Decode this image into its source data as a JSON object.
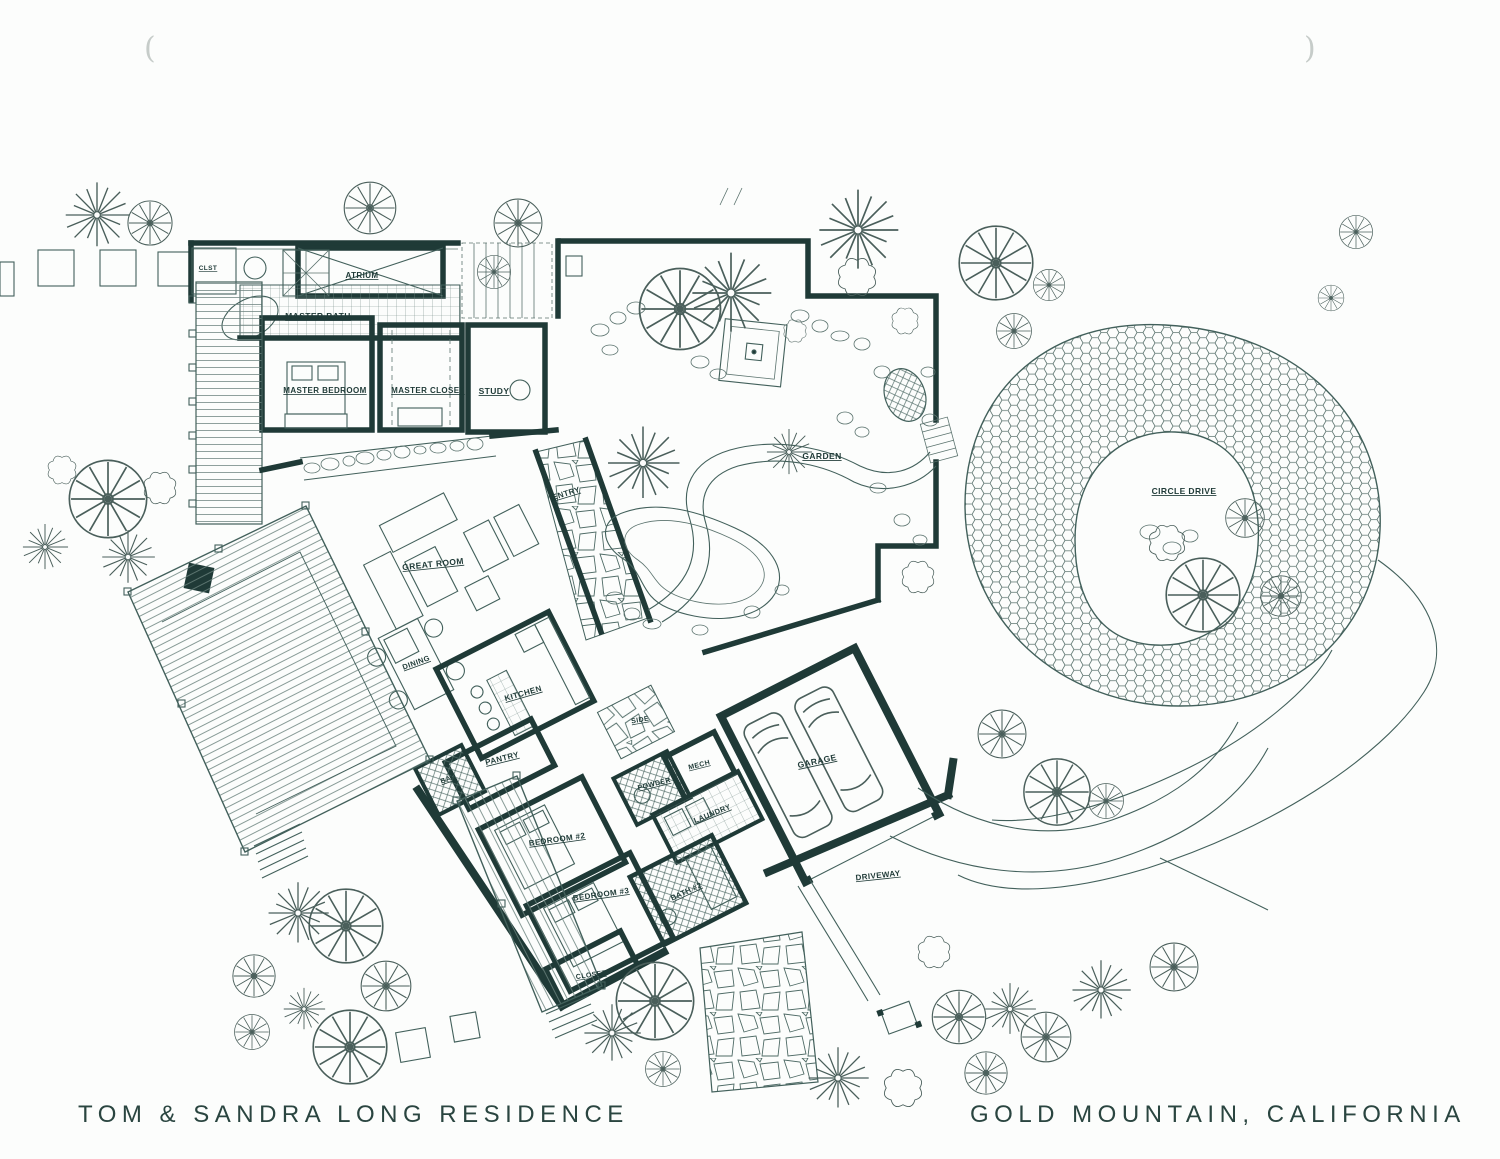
{
  "title": "TOM & SANDRA LONG RESIDENCE",
  "location": "GOLD MOUNTAIN, CALIFORNIA",
  "colors": {
    "ink": "#1f3a37",
    "paper": "#fcfdfc"
  },
  "rooms": {
    "clst": "CLST",
    "atrium": "ATRIUM",
    "master_bath": "MASTER BATH",
    "master_bedroom": "MASTER BEDROOM",
    "master_closet": "MASTER CLOSET",
    "study": "STUDY",
    "entry": "ENTRY",
    "great_room": "GREAT ROOM",
    "dining": "DINING",
    "kitchen": "KITCHEN",
    "pantry": "PANTRY",
    "bar": "BAR",
    "side": "SIDE",
    "powder": "POWDER",
    "mech": "MECH",
    "laundry": "LAUNDRY",
    "bedroom2": "BEDROOM #2",
    "bedroom3": "BEDROOM #3",
    "bath2": "BATH #2",
    "closet": "CLOSET",
    "garage": "GARAGE"
  },
  "site": {
    "garden": "GARDEN",
    "circle_drive": "CIRCLE DRIVE",
    "driveway": "DRIVEWAY"
  }
}
